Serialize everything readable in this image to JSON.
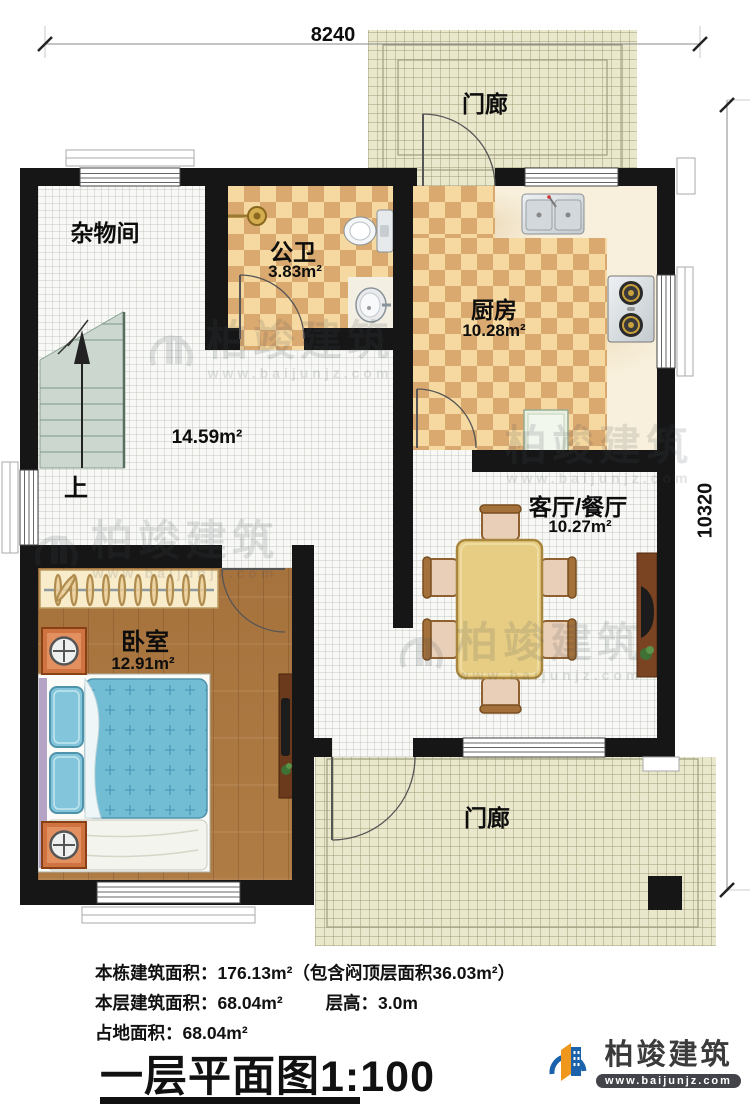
{
  "dimensions": {
    "top": "8240",
    "right": "10320"
  },
  "rooms": {
    "porch_top": {
      "label": "门廊"
    },
    "storage": {
      "label": "杂物间"
    },
    "bathroom": {
      "label": "公卫",
      "area": "3.83m²"
    },
    "kitchen": {
      "label": "厨房",
      "area": "10.28m²"
    },
    "hall": {
      "area": "14.59m²",
      "stairs_up": "上"
    },
    "living": {
      "label": "客厅/餐厅",
      "area": "10.27m²"
    },
    "bedroom": {
      "label": "卧室",
      "area": "12.91m²"
    },
    "porch_bottom": {
      "label": "门廊"
    }
  },
  "info": {
    "total": "本栋建筑面积：176.13m²（包含闷顶层面积36.03m²）",
    "floor": "本层建筑面积：68.04m²",
    "height": "层高：3.0m",
    "footprint": "占地面积：68.04m²",
    "title": "一层平面图1:100"
  },
  "brand": {
    "name": "柏竣建筑",
    "url": "www.baijunjz.com"
  },
  "watermark": {
    "name": "柏竣建筑",
    "url": "www.baijunjz.com"
  },
  "colors": {
    "wall": "#161616",
    "checker_light": "#f6d9a0",
    "checker_dark": "#d9a96f",
    "porch": "#e9e7cc",
    "wood": "#b07c46",
    "bed_blue": "#72bcd4",
    "logo_blue": "#1b62ac",
    "logo_orange": "#f0981e"
  }
}
